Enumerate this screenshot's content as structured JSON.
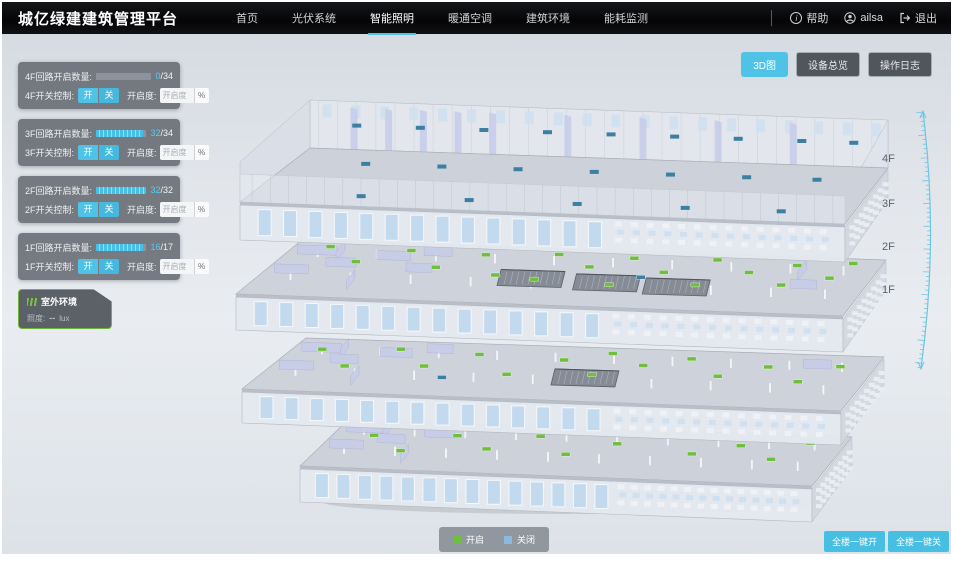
{
  "header": {
    "title": "城亿绿建建筑管理平台",
    "nav": [
      {
        "label": "首页",
        "active": false
      },
      {
        "label": "光伏系统",
        "active": false
      },
      {
        "label": "智能照明",
        "active": true
      },
      {
        "label": "暖通空调",
        "active": false
      },
      {
        "label": "建筑环境",
        "active": false
      },
      {
        "label": "能耗监测",
        "active": false
      }
    ],
    "help_label": "帮助",
    "username": "ailsa",
    "logout_label": "退出"
  },
  "view_toolbar": {
    "buttons": [
      {
        "label": "3D图",
        "active": true
      },
      {
        "label": "设备总览",
        "active": false
      },
      {
        "label": "操作日志",
        "active": false
      }
    ]
  },
  "floor_panels": [
    {
      "floor": "4F",
      "count_label": "4F回路开启数量:",
      "count_on": "0",
      "count_slash": "/",
      "count_total": "34",
      "progress_pct": 0,
      "switch_label": "4F开关控制:",
      "btn_on": "开",
      "btn_off": "关",
      "dim_label": "开启度:",
      "dim_placeholder": "开启度",
      "unit": "%"
    },
    {
      "floor": "3F",
      "count_label": "3F回路开启数量:",
      "count_on": "32",
      "count_slash": "/",
      "count_total": "34",
      "progress_pct": 94,
      "switch_label": "3F开关控制:",
      "btn_on": "开",
      "btn_off": "关",
      "dim_label": "开启度:",
      "dim_placeholder": "开启度",
      "unit": "%"
    },
    {
      "floor": "2F",
      "count_label": "2F回路开启数量:",
      "count_on": "32",
      "count_slash": "/",
      "count_total": "32",
      "progress_pct": 100,
      "switch_label": "2F开关控制:",
      "btn_on": "开",
      "btn_off": "关",
      "dim_label": "开启度:",
      "dim_placeholder": "开启度",
      "unit": "%"
    },
    {
      "floor": "1F",
      "count_label": "1F回路开启数量:",
      "count_on": "16",
      "count_slash": "/",
      "count_total": "17",
      "progress_pct": 94,
      "switch_label": "1F开关控制:",
      "btn_on": "开",
      "btn_off": "关",
      "dim_label": "开启度:",
      "dim_placeholder": "开启度",
      "unit": "%"
    }
  ],
  "outdoor_panel": {
    "title": "室外环境",
    "metric_label": "照度:",
    "metric_value": "--",
    "metric_unit": "lux"
  },
  "floor_labels": [
    "4F",
    "3F",
    "2F",
    "1F"
  ],
  "legend": {
    "on_label": "开启",
    "off_label": "关闭"
  },
  "bulk_controls": [
    {
      "label": "全楼一键开"
    },
    {
      "label": "全楼一键关"
    }
  ],
  "colors": {
    "accent": "#4ec3e6",
    "light_on": "#6fbe3e",
    "light_off": "#8cb9de",
    "marker_teal": "#3b7fa1",
    "ruler": "#6cc6e2"
  }
}
